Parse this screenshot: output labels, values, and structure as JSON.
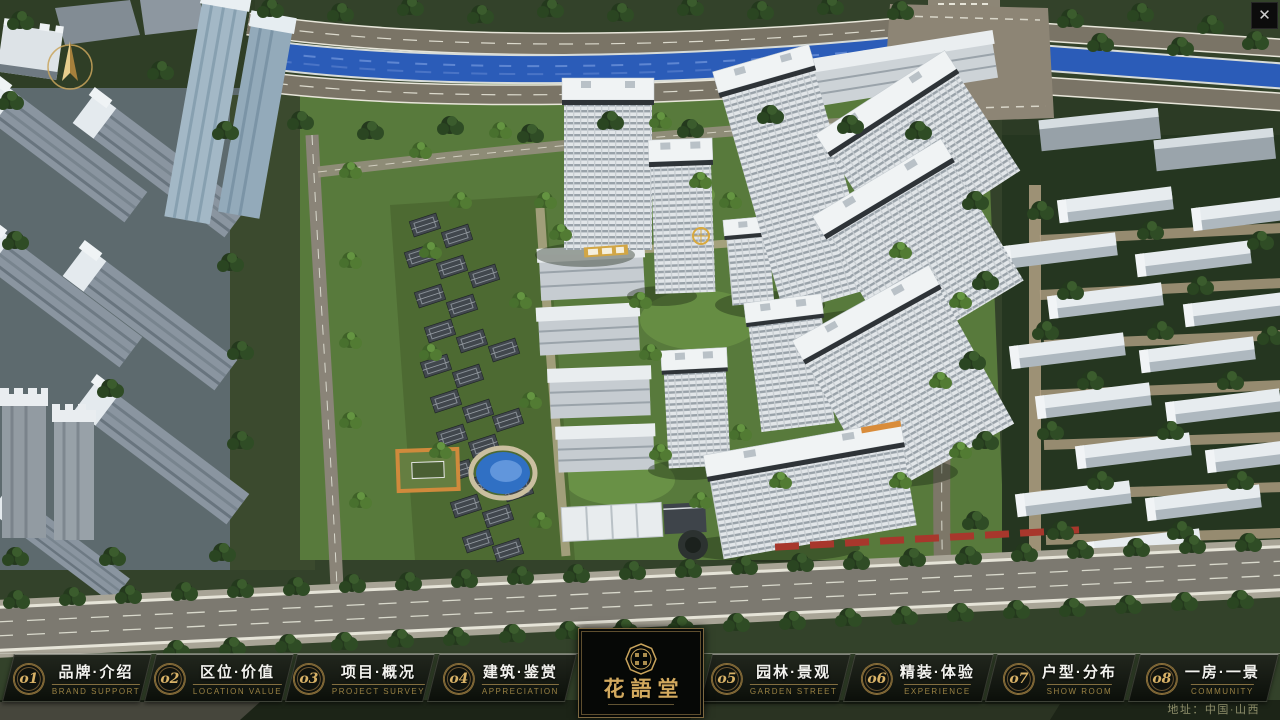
{
  "nav": {
    "items": [
      {
        "num": "o1",
        "zh": "品牌·介绍",
        "en": "BRAND SUPPORT"
      },
      {
        "num": "o2",
        "zh": "区位·价值",
        "en": "LOCATION VALUE"
      },
      {
        "num": "o3",
        "zh": "项目·概况",
        "en": "PROJECT SURVEY"
      },
      {
        "num": "o4",
        "zh": "建筑·鉴赏",
        "en": "APPRECIATION"
      },
      {
        "num": "o5",
        "zh": "园林·景观",
        "en": "GARDEN STREET"
      },
      {
        "num": "o6",
        "zh": "精装·体验",
        "en": "EXPERIENCE"
      },
      {
        "num": "o7",
        "zh": "户型·分布",
        "en": "SHOW ROOM"
      },
      {
        "num": "o8",
        "zh": "一房·一景",
        "en": "COMMUNITY"
      }
    ]
  },
  "logo": {
    "title": "花語堂"
  },
  "footer": {
    "address": "地址：中国·山西"
  },
  "chrome": {
    "close_glyph": "✕"
  },
  "colors": {
    "gold_accent": "#c9a45c",
    "nav_background": "#0c100b",
    "river_blue": "#2b5cb8",
    "close_button_bg": "#0c0c0c"
  }
}
